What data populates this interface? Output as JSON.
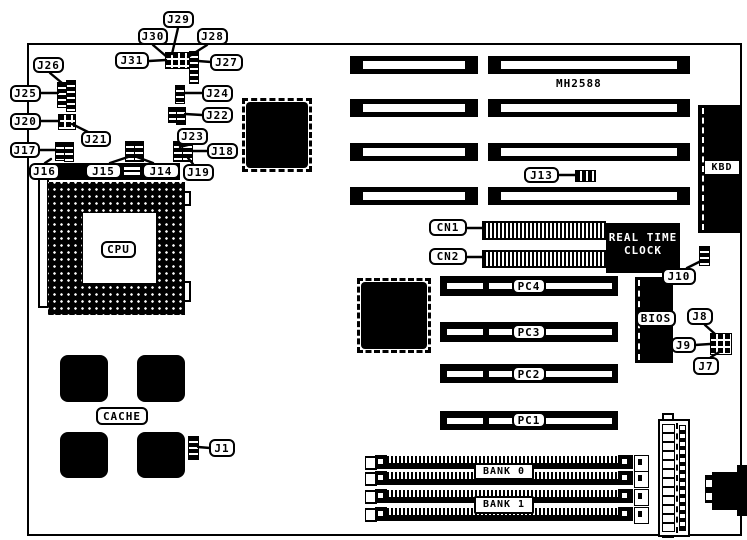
{
  "diagram": {
    "model": "MH2588",
    "jumpers": {
      "j1": "J1",
      "j7": "J7",
      "j8": "J8",
      "j9": "J9",
      "j10": "J10",
      "j13": "J13",
      "j14": "J14",
      "j15": "J15",
      "j16": "J16",
      "j17": "J17",
      "j18": "J18",
      "j19": "J19",
      "j20": "J20",
      "j21": "J21",
      "j22": "J22",
      "j23": "J23",
      "j24": "J24",
      "j25": "J25",
      "j26": "J26",
      "j27": "J27",
      "j28": "J28",
      "j29": "J29",
      "j30": "J30",
      "j31": "J31"
    },
    "connectors": {
      "cn1": "CN1",
      "cn2": "CN2",
      "kbd": "KBD"
    },
    "slots": {
      "pc1": "PC1",
      "pc2": "PC2",
      "pc3": "PC3",
      "pc4": "PC4"
    },
    "memory": {
      "bank0": "BANK 0",
      "bank1": "BANK 1"
    },
    "chips": {
      "cpu": "CPU",
      "cache": "CACHE",
      "bios": "BIOS",
      "rtc_line1": "REAL TIME",
      "rtc_line2": "CLOCK"
    }
  }
}
